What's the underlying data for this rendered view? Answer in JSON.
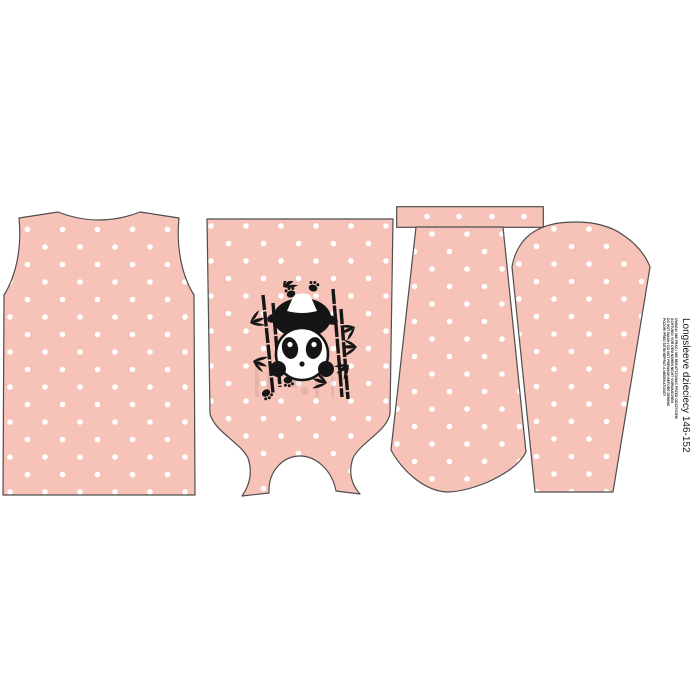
{
  "panel": {
    "background_color": "#ffffff",
    "fabric": {
      "base_color": "#f7c3b8",
      "dot_color": "#ffffff",
      "outline_color": "#4d4d4d",
      "print_ink_color": "#151515"
    },
    "side_label": {
      "title": "Longsleeve dzieciecy 146-152",
      "care_lines": [
        "UWAGA! NIE PRAĆ / NIE DEKATYZOWAĆ PRZED ODSZYCIEM",
        "ACHTUNG! VOR DEM NÄHEN NICHT VORWASCHEN",
        "DO NOT WASH / DO NOT PREWASH BEFORE SEWING",
        "POZOR! PŘED ŠITÍM NEPRAT A NEDEKATOVAT!"
      ]
    },
    "pieces": [
      {
        "id": "back",
        "desc": "back bodice piece"
      },
      {
        "id": "front",
        "desc": "front bodice piece with panda print, laid upside down"
      },
      {
        "id": "neckband",
        "desc": "neckband strip"
      },
      {
        "id": "sleeve-1",
        "desc": "sleeve piece, cap edge down"
      },
      {
        "id": "sleeve-2",
        "desc": "sleeve piece, cap edge up"
      }
    ],
    "motif": {
      "id": "panda-bamboo",
      "desc": "panda hanging between bamboo stalks with paw prints"
    }
  }
}
